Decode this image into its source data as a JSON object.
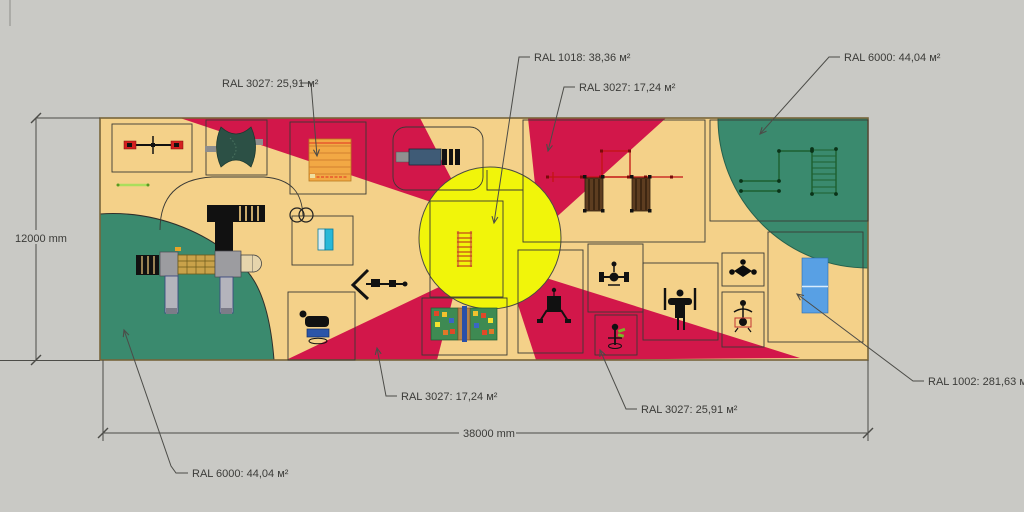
{
  "document": {
    "type": "playground-surfacing-plan",
    "background_color": "#c9c9c5"
  },
  "dimensions": {
    "height_label": "12000 mm",
    "width_label": "38000 mm"
  },
  "area_labels": {
    "top_left": "RAL 3027: 25,91 м²",
    "top_center": "RAL 1018: 38,36 м²",
    "top_center_right": "RAL 3027: 17,24 м²",
    "top_right": "RAL 6000: 44,04 м²",
    "bottom_left": "RAL 6000: 44,04 м²",
    "bottom_center_left": "RAL 3027: 17,24 м²",
    "bottom_center_right": "RAL 3027: 25,91 м²",
    "right": "RAL 1002: 281,63 м²"
  },
  "surface_colors": {
    "RAL 1002": "#f4d189",
    "RAL 1018": "#f1f50a",
    "RAL 3027": "#d2174a",
    "RAL 6000": "#3a8a6e"
  },
  "accent_colors": {
    "table_tennis_blue": "#58a0e4",
    "panel_cyan": "#28b8d8",
    "picnic_table_orange": "#f2a844",
    "leader_line_gray": "#4c4c48"
  },
  "equipment_icons": [
    "seesaw-icon",
    "spring-rider-x-icon",
    "picnic-table-icon",
    "bench-icon",
    "swing-set-icon",
    "monkey-bars-icon",
    "table-tennis-icon",
    "trapeze-icon",
    "balance-figure-icon",
    "gym-station-icon",
    "barbell-station-icon",
    "climber-figure-icon",
    "spring-rider-icon",
    "game-tables-icon",
    "spring-horse-icon",
    "chevron-swing-icon",
    "play-complex-icon",
    "climbing-ladder-icon",
    "tunnel-rings-icon",
    "small-bench-icon",
    "panel-icon"
  ]
}
